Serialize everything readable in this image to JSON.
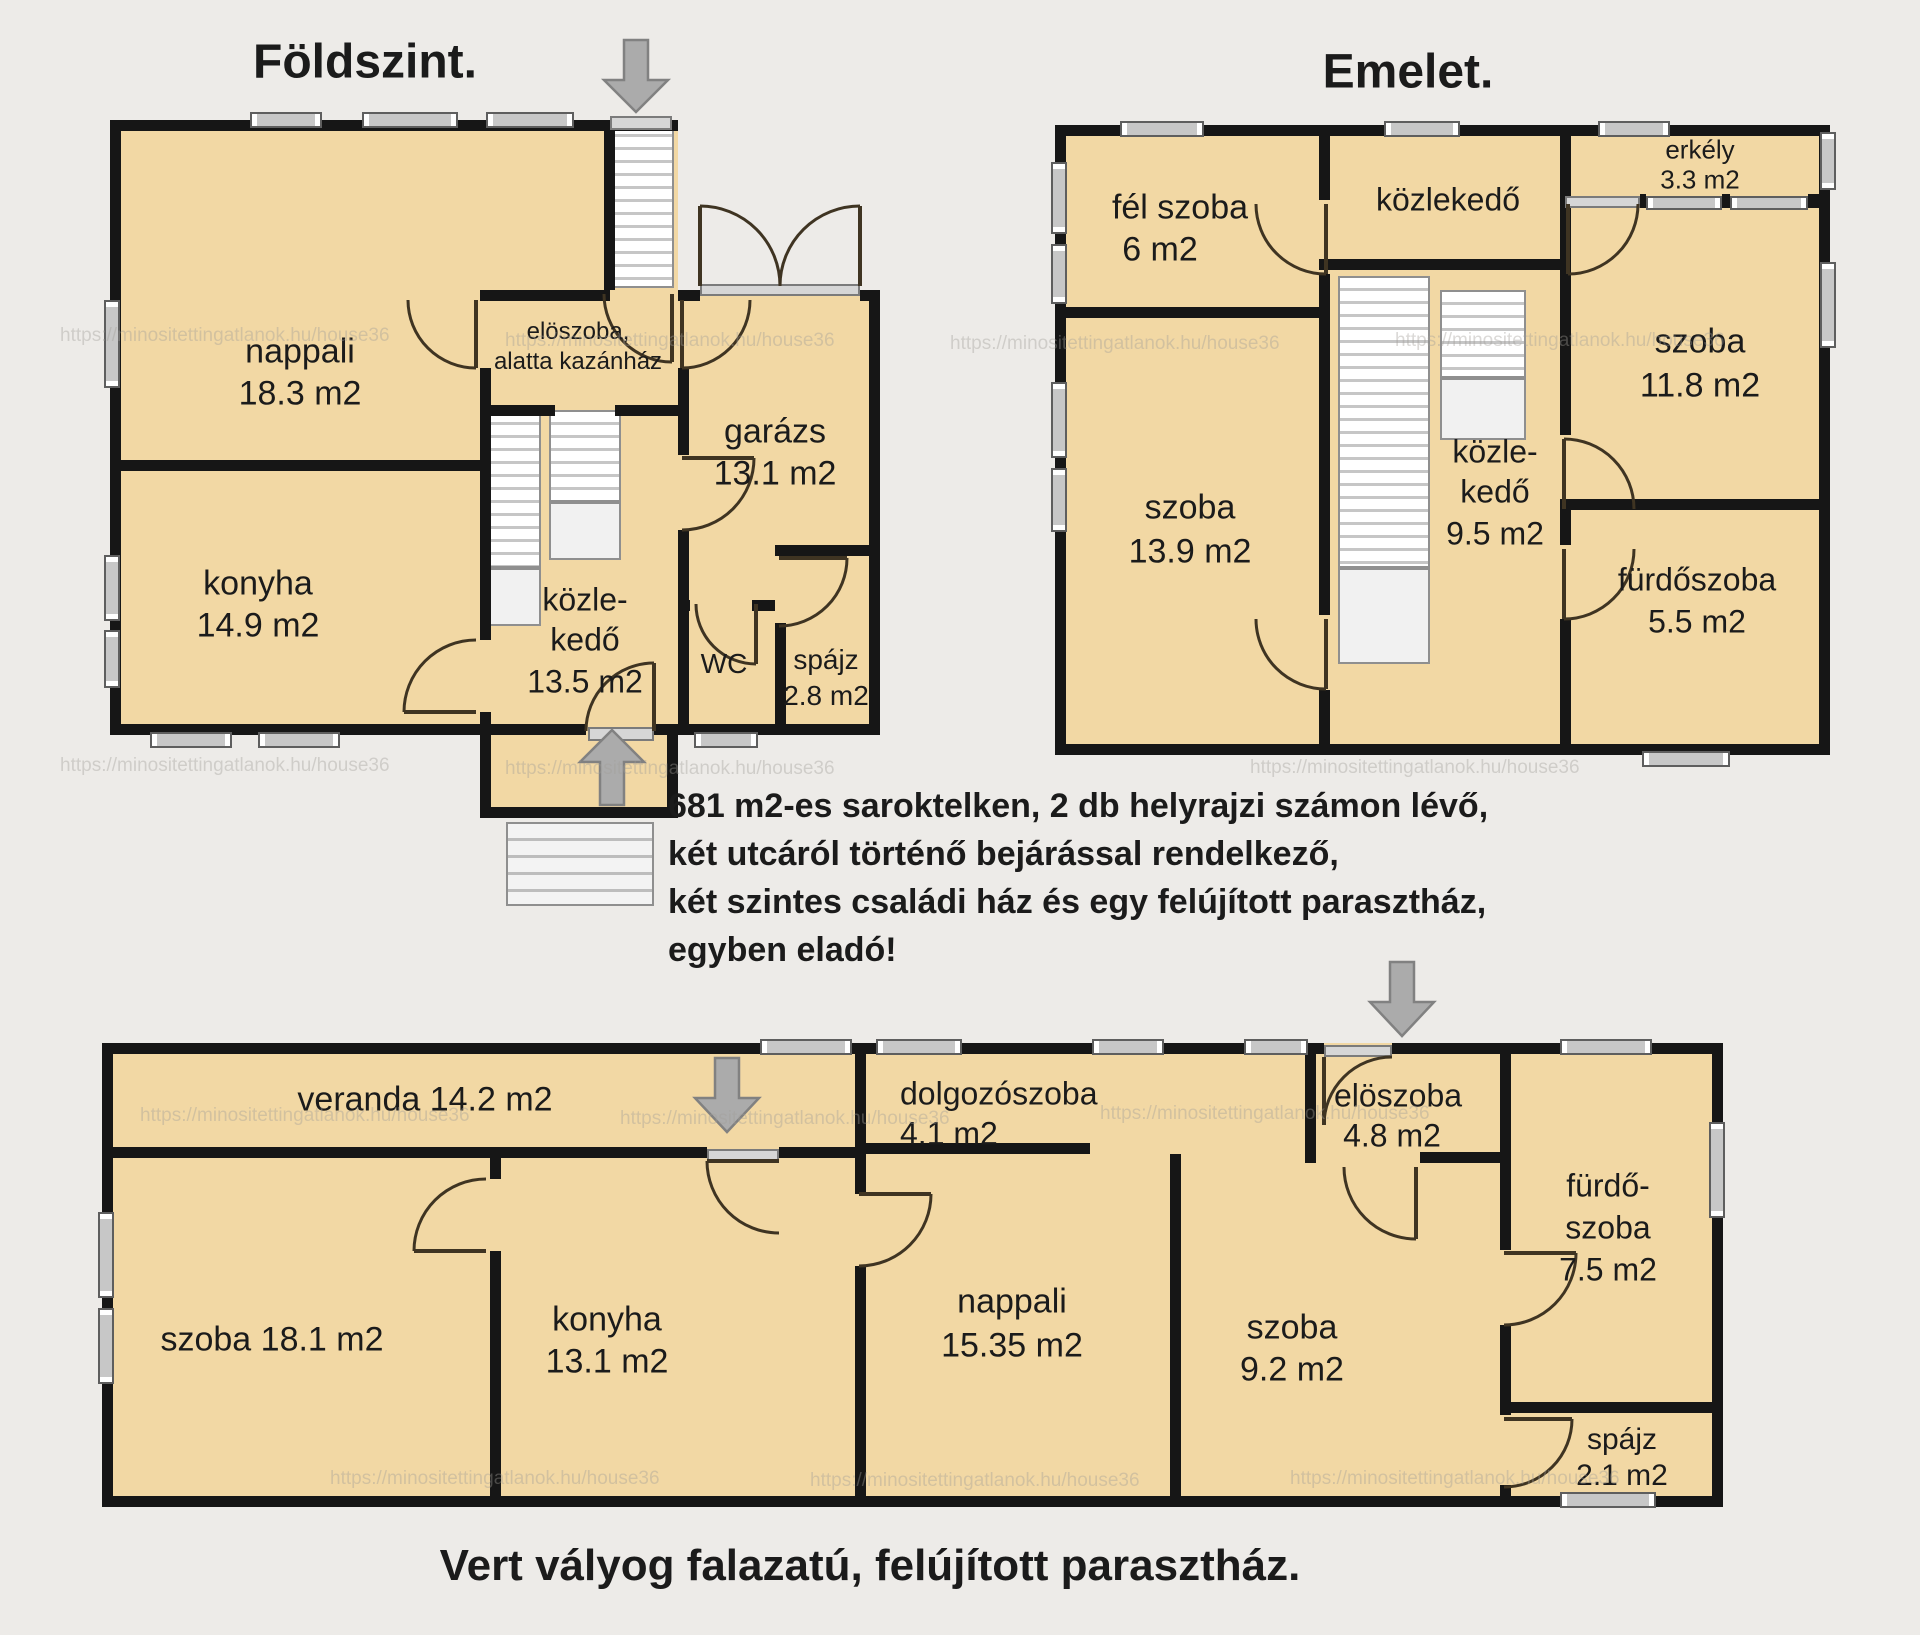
{
  "ground_floor": {
    "title": "Földszint.",
    "rooms": {
      "nappali": {
        "name": "nappali",
        "area": "18.3 m2"
      },
      "eloszoba": {
        "line1": "elöszoba,",
        "line2": "alatta kazánház"
      },
      "garazs": {
        "name": "garázs",
        "area": "13.1 m2"
      },
      "konyha": {
        "name": "konyha",
        "area": "14.9 m2"
      },
      "kozlekedo": {
        "line1": "közle-",
        "line2": "kedő",
        "area": "13.5 m2"
      },
      "wc": {
        "name": "WC"
      },
      "spajz": {
        "name": "spájz",
        "area": "2.8 m2"
      }
    }
  },
  "upper_floor": {
    "title": "Emelet.",
    "rooms": {
      "fel_szoba": {
        "name": "fél szoba",
        "area": "6 m2"
      },
      "kozlekedo_felso": {
        "name": "közlekedő"
      },
      "erkely": {
        "name": "erkély",
        "area": "3.3 m2"
      },
      "szoba_11_8": {
        "name": "szoba",
        "area": "11.8 m2"
      },
      "kozlekedo_kozep": {
        "line1": "közle-",
        "line2": "kedő",
        "area": "9.5 m2"
      },
      "szoba_13_9": {
        "name": "szoba",
        "area": "13.9 m2"
      },
      "furdoszoba": {
        "name": "fürdőszoba",
        "area": "5.5 m2"
      }
    }
  },
  "description": {
    "line1": "681 m2-es saroktelken, 2 db helyrajzi számon lévő,",
    "line2": "két utcáról történő bejárással rendelkező,",
    "line3": "két szintes családi ház és egy felújított parasztház,",
    "line4": "egyben eladó!"
  },
  "farmhouse": {
    "caption": "Vert vályog falazatú, felújított parasztház.",
    "rooms": {
      "veranda": {
        "name": "veranda 14.2 m2"
      },
      "szoba_18_1": {
        "name": "szoba 18.1 m2"
      },
      "konyha": {
        "name": "konyha",
        "area": "13.1 m2"
      },
      "dolgozoszoba": {
        "name": "dolgozószoba",
        "area": "4.1 m2"
      },
      "nappali": {
        "name": "nappali",
        "area": "15.35 m2"
      },
      "eloszoba": {
        "name": "elöszoba",
        "area": "4.8 m2"
      },
      "szoba_9_2": {
        "name": "szoba",
        "area": "9.2 m2"
      },
      "furdoszoba": {
        "line1": "fürdő-",
        "line2": "szoba",
        "area": "7.5 m2"
      },
      "spajz": {
        "name": "spájz",
        "area": "2.1 m2"
      }
    }
  },
  "watermark": "https://minositettingatlanok.hu/house36",
  "icons": {
    "entry_arrow_down": "arrow-down",
    "exit_arrow_up": "arrow-up"
  },
  "colors": {
    "room_fill": "#f2d8a4",
    "wall": "#161616",
    "background": "#edebe8",
    "stair_tread": "#c6c6c6",
    "window": "#c7c7c7"
  }
}
